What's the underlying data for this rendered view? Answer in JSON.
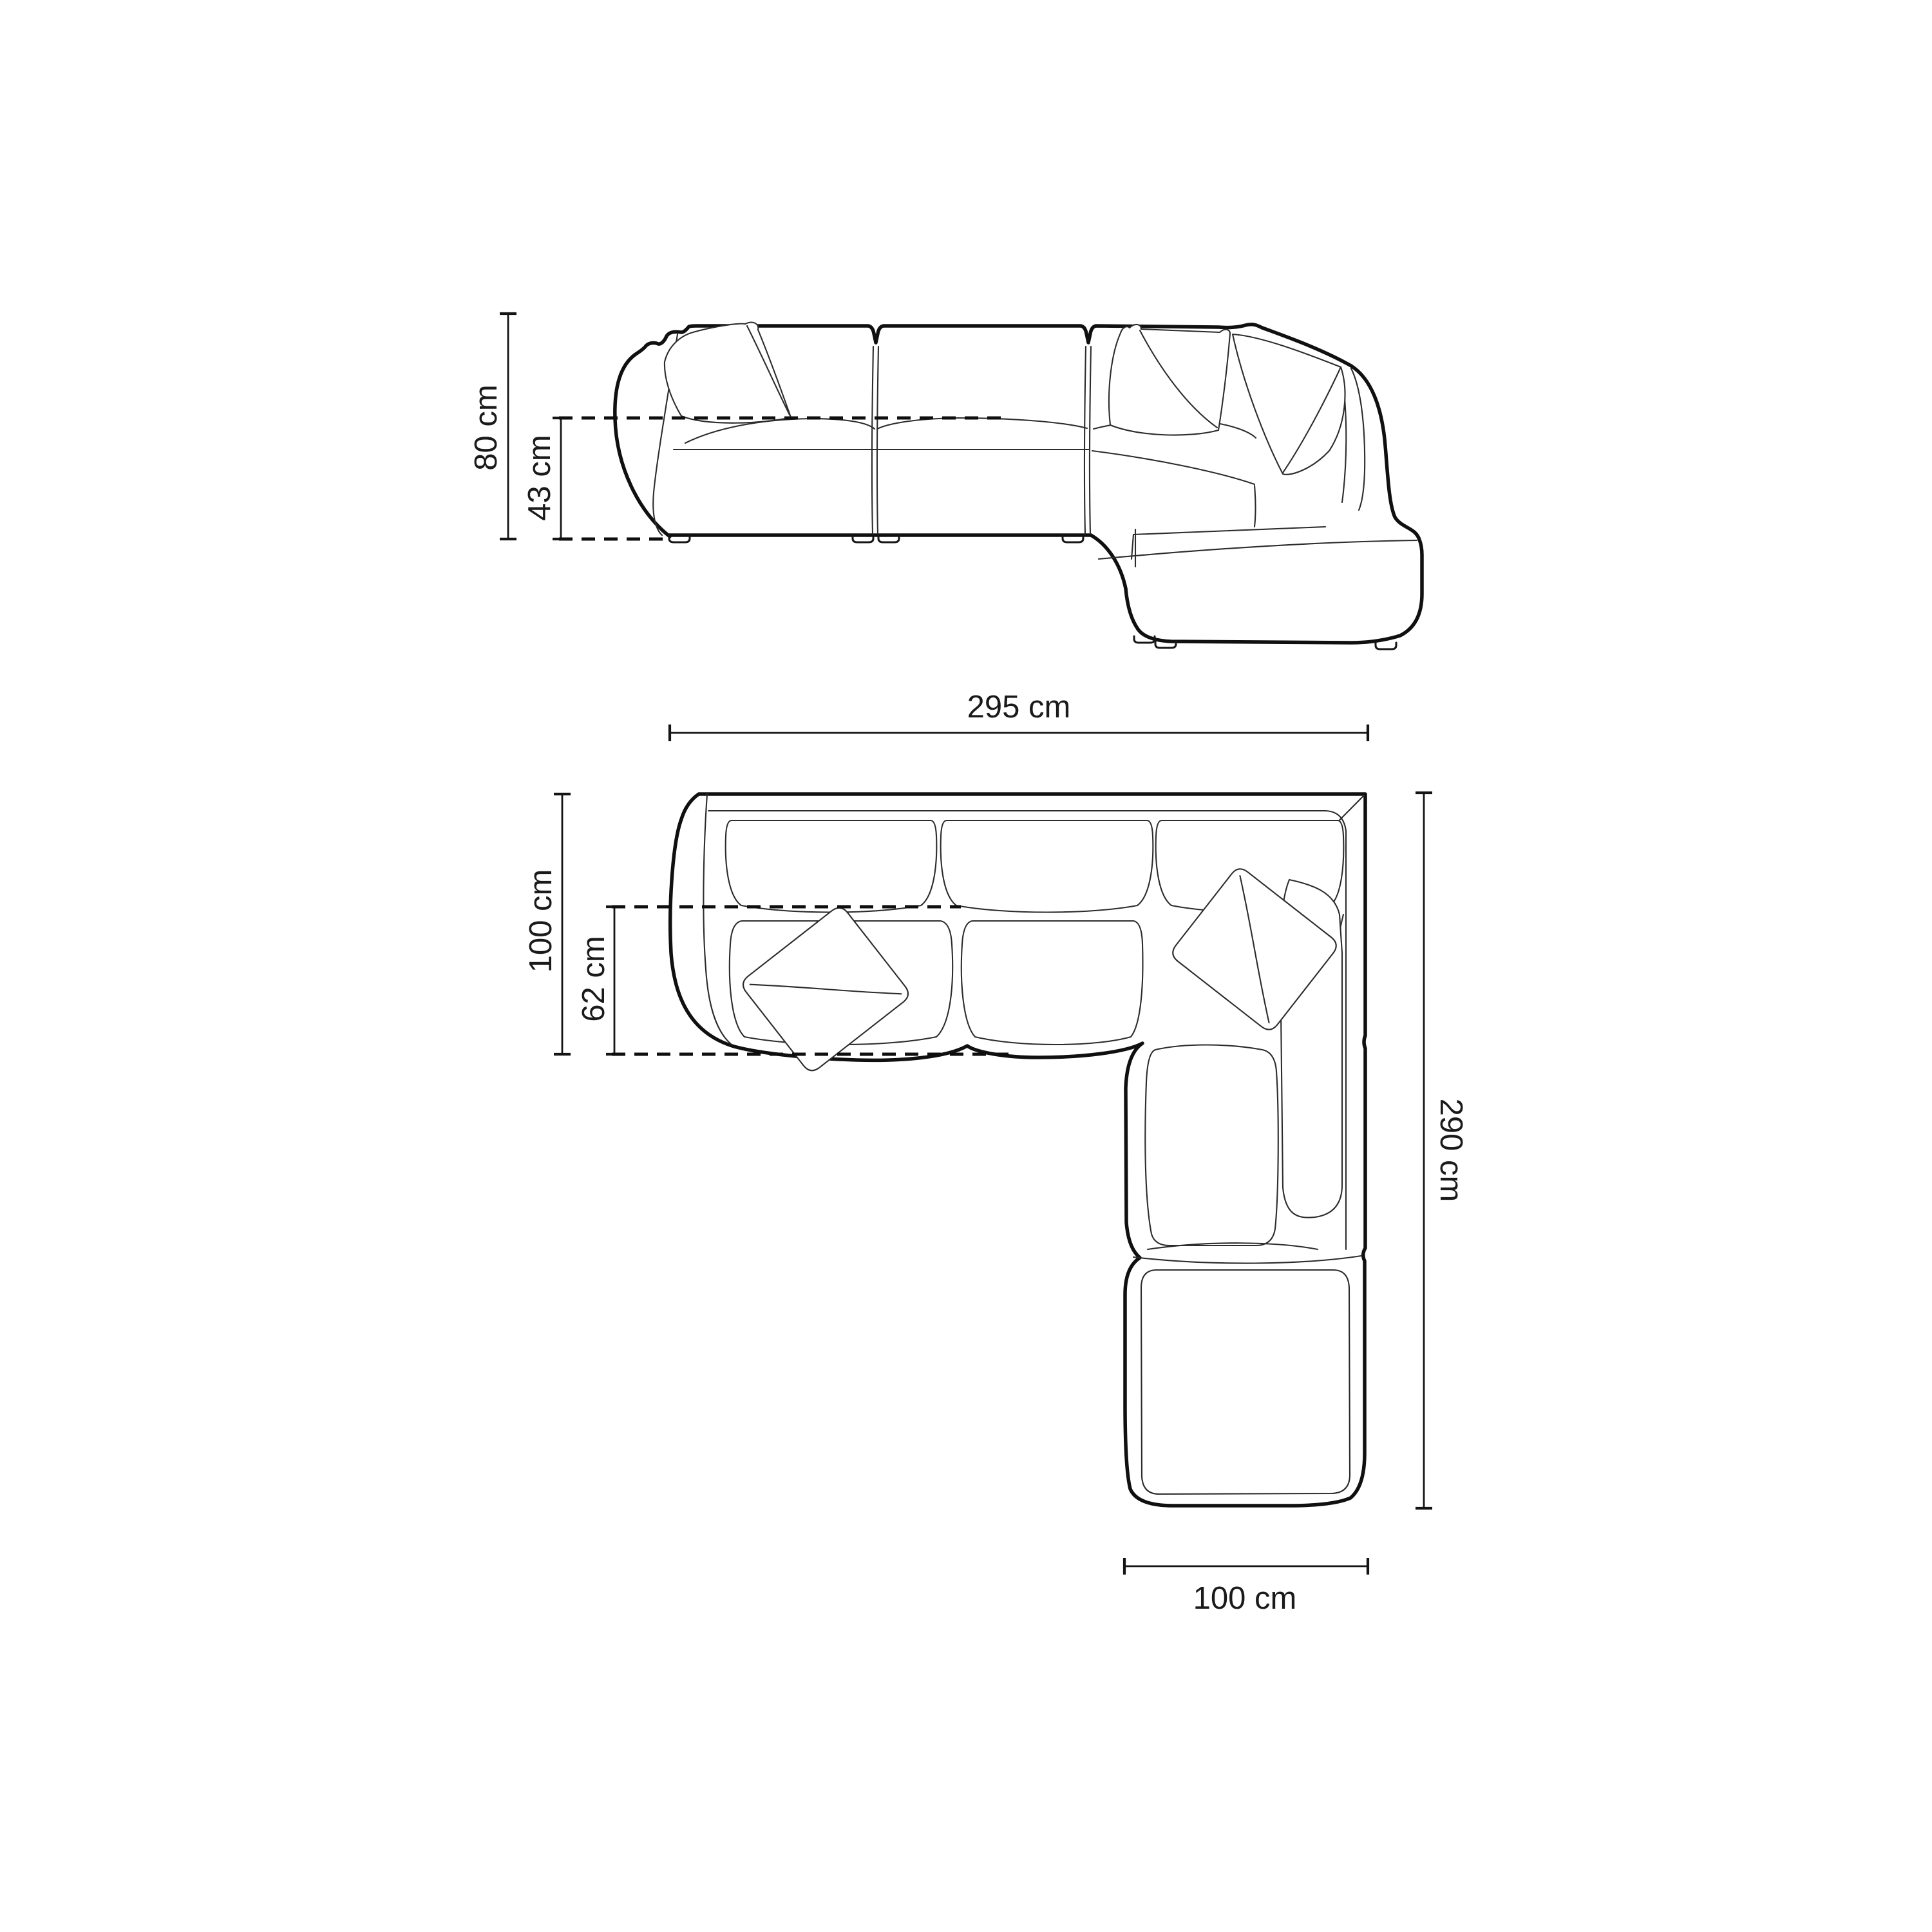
{
  "diagram": {
    "type": "sofa-dimension-technical-drawing",
    "background": "#ffffff",
    "line_color": "#141414",
    "views": {
      "front": {
        "name": "front-elevation-view",
        "dimensions": {
          "total_height": "80 cm",
          "seat_height": "43 cm"
        }
      },
      "top": {
        "name": "top-plan-view",
        "dimensions": {
          "total_width": "295 cm",
          "total_depth": "100 cm",
          "seat_depth": "62 cm",
          "total_length": "290 cm",
          "ottoman_width": "100 cm"
        }
      }
    }
  }
}
